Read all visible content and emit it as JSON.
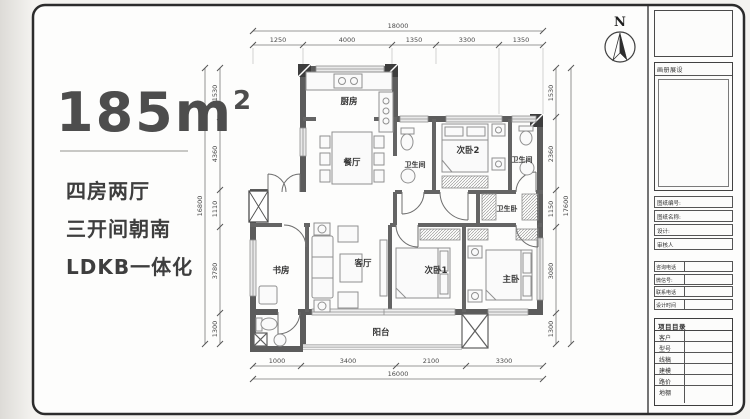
{
  "summary": {
    "area": "185m",
    "area_exp": "2",
    "line1": "四房两厅",
    "line2": "三开间朝南",
    "line3": "LDKB一体化"
  },
  "compass": {
    "north": "N"
  },
  "rooms": {
    "kitchen": "厨房",
    "dining": "餐厅",
    "bath1": "卫生间",
    "bedroom2": "次卧2",
    "bath2": "卫生间",
    "closet": "卫生卧",
    "study": "书房",
    "living": "客厅",
    "bedroom1": "次卧1",
    "master": "主卧",
    "balcony": "阳台"
  },
  "dimensions": {
    "top": {
      "total": "18000",
      "segments": [
        "1250",
        "4000",
        "1350",
        "3300",
        "1350"
      ]
    },
    "left": {
      "total": "16800",
      "segments": [
        "1530",
        "4360",
        "1110",
        "3780",
        "1300"
      ]
    },
    "right": {
      "total": "17600",
      "segments": [
        "1530",
        "2360",
        "1150",
        "3080",
        "1300"
      ]
    },
    "bottom": {
      "total": "16000",
      "segments": [
        "1000",
        "3400",
        "2100",
        "3300"
      ]
    }
  },
  "titleblock": {
    "gallery_header": "画册展设",
    "fields": [
      "图纸编号:",
      "图纸名称:",
      "设计:",
      "审核人"
    ],
    "contacts": [
      "咨询电话",
      "微信号:",
      "联系电话",
      "设计时间"
    ],
    "directory": {
      "header": "项目目录",
      "rows": [
        "客户",
        "型号",
        "线稿",
        "建模",
        "路价",
        "地棚"
      ]
    }
  },
  "colors": {
    "wall": "#5c5c5c",
    "border": "#2c2c2c",
    "accent_text": "#4d4d4d"
  }
}
